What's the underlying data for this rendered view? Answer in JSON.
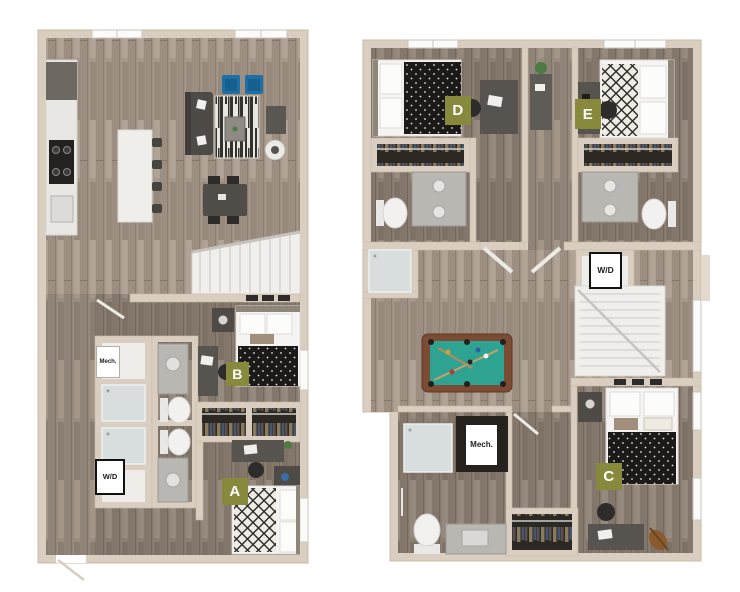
{
  "scene": {
    "description": "Two-level 3D apartment floor plan rendering, levels shown side by side on white background",
    "background": "#ffffff"
  },
  "palette": {
    "badge": "#878a3c",
    "badge_text": "#ffffff",
    "wall": "#d9cec0",
    "floor_light_wood": "#a5978a",
    "floor_dark_wood": "#8c7f74",
    "pool_felt": "#2fa392",
    "accent_chair_blue": "#1d6fa5",
    "bedding_black": "#1b1a19",
    "fixture_white": "#f4f3f1"
  },
  "floor1": {
    "badges": {
      "a": "A",
      "b": "B"
    },
    "utilities": {
      "mech": "Mech.",
      "wd": "W/D"
    }
  },
  "floor2": {
    "badges": {
      "c": "C",
      "d": "D",
      "e": "E"
    },
    "utilities": {
      "wd": "W/D",
      "mech": "Mech."
    }
  }
}
